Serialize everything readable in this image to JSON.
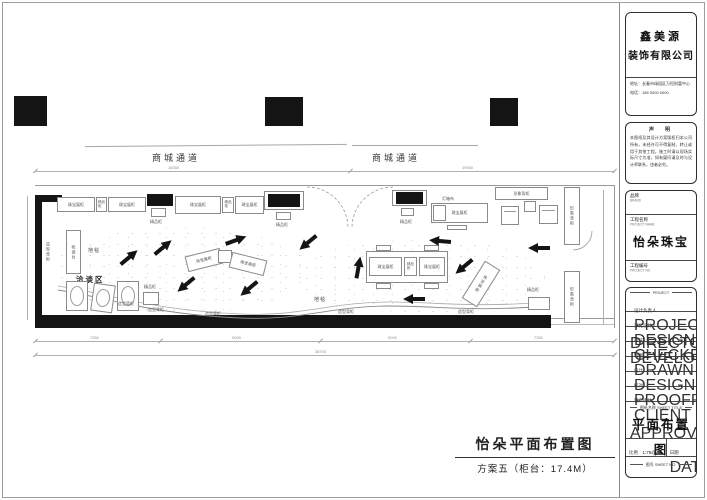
{
  "plan": {
    "corridor_label": "商城通道",
    "labels": {
      "jewelry_counter": "珠宝展柜",
      "boutique_counter": "精品柜",
      "shaped_back_counter": "造型背柜",
      "image_back_counter": "形象背柜",
      "cashier_counter": "收银台",
      "lightbox": "灯箱布",
      "carpet": "地毯",
      "negotiation_area": "洽谈区"
    },
    "dimensions": {
      "top_seg_1": "18350",
      "top_seg_2": "19050",
      "bottom_seg_1": "7350",
      "bottom_seg_2": "9000",
      "bottom_seg_3": "9000",
      "bottom_seg_4": "7350",
      "bottom_total": "38700"
    },
    "footer": {
      "title": "怡朵平面布置图",
      "subtitle": "方案五（柜台：17.4M）"
    }
  },
  "title_block": {
    "company": {
      "name_line1": "鑫美源",
      "name_line2": "装饰有限公司",
      "address": "地址：长春市绿园区万恒财富中心",
      "phone": "电话：186 0000 0000"
    },
    "notice": {
      "heading": "声　明",
      "body": "本图纸及其设计方案版权归本公司所有，未经许可不得复制、转让或用于其他工程。施工时请以现场实际尺寸为准，如有疑问请及时与设计师联系，违者必究。"
    },
    "project": {
      "brand_label": "品牌",
      "brand_sub": "BRAND",
      "name_label": "工程名称",
      "name_sub": "PROJECT NAME",
      "name_value": "怡朵珠宝",
      "number_label": "工程编号",
      "number_sub": "PROJECT NO."
    },
    "personnel_header": "PROJECT",
    "personnel": [
      {
        "label": "设计负责人",
        "sub": "PROJECT DIRECTOR"
      },
      {
        "label": "深化设计人",
        "sub": "DESIGN DEVELOPER"
      },
      {
        "label": "审核",
        "sub": "CHECKED"
      },
      {
        "label": "制图",
        "sub": "DRAWN"
      },
      {
        "label": "设计",
        "sub": "DESIGNED"
      },
      {
        "label": "校对",
        "sub": "PROOFREAD"
      },
      {
        "label": "客户确认",
        "sub": "CLIENT APPROVAL"
      }
    ],
    "sheet": {
      "title_label": "图纸名称 SHEET TITLE",
      "title": "平面布置图",
      "scale_label": "比例",
      "scale_sub": "SCALE",
      "scale_value": "1:75@A3",
      "date_label": "日期",
      "date_sub": "DATE",
      "number_label": "图号 SHEET NO."
    }
  }
}
